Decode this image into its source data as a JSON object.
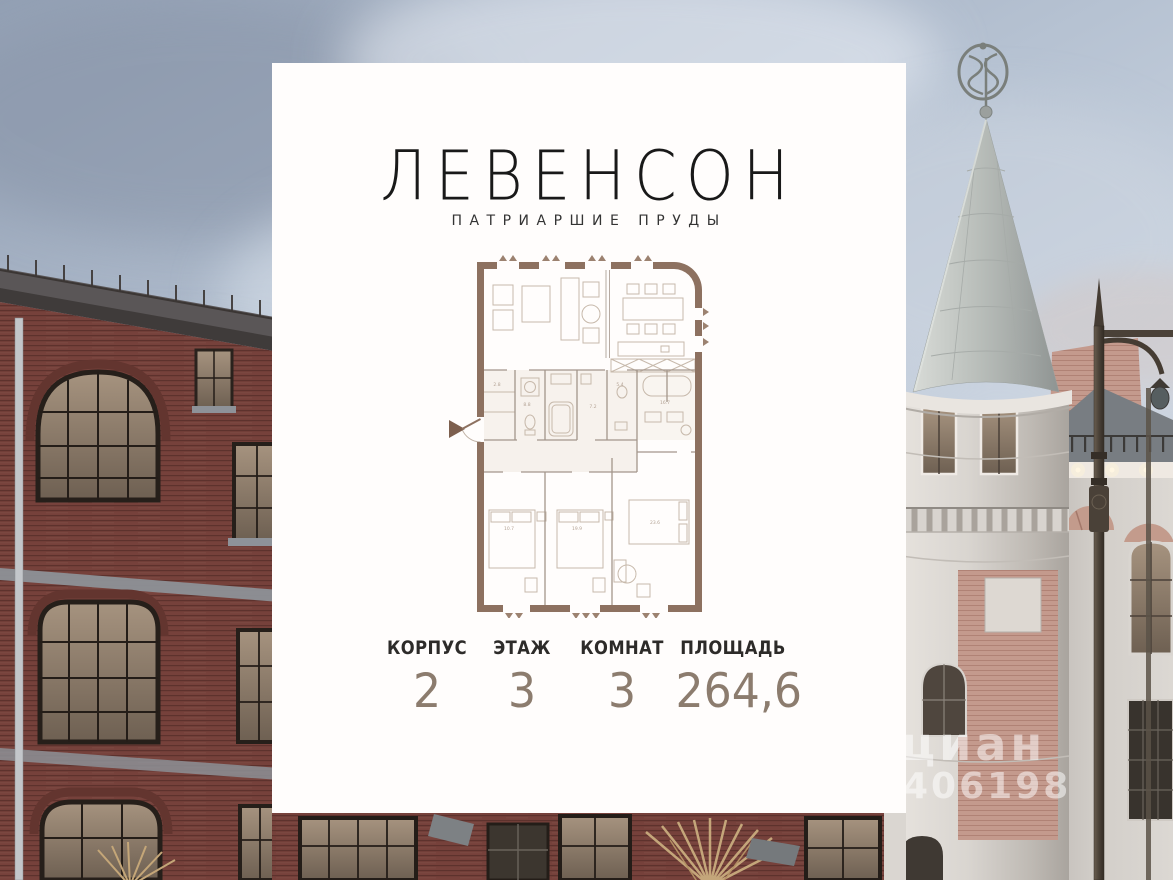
{
  "card": {
    "brand_title": "ЛЕВЕНСОН",
    "brand_subtitle": "ПАТРИАРШИЕ ПРУДЫ",
    "stats": [
      {
        "label": "КОРПУС",
        "value": "2"
      },
      {
        "label": "ЭТАЖ",
        "value": "3"
      },
      {
        "label": "КОМНАТ",
        "value": "3"
      },
      {
        "label": "ПЛОЩАДЬ",
        "value": "264,6"
      }
    ]
  },
  "floor_plan": {
    "kind": "apartment-floor-plan",
    "area_labels": [
      "23.6",
      "19.9",
      "10.7",
      "8.8",
      "7.2",
      "5.4",
      "2.8",
      "16.7"
    ]
  },
  "watermark": {
    "brand": "циан",
    "number": "406198"
  },
  "colors": {
    "card_bg": "#fffdfc",
    "plan_wall": "#8d7160",
    "stat_value": "#8c7c6e",
    "brick": "#76413b",
    "cone_roof": "#b9beba",
    "cream_wall": "#d9d5d0",
    "sky": "#c4cfdc"
  }
}
